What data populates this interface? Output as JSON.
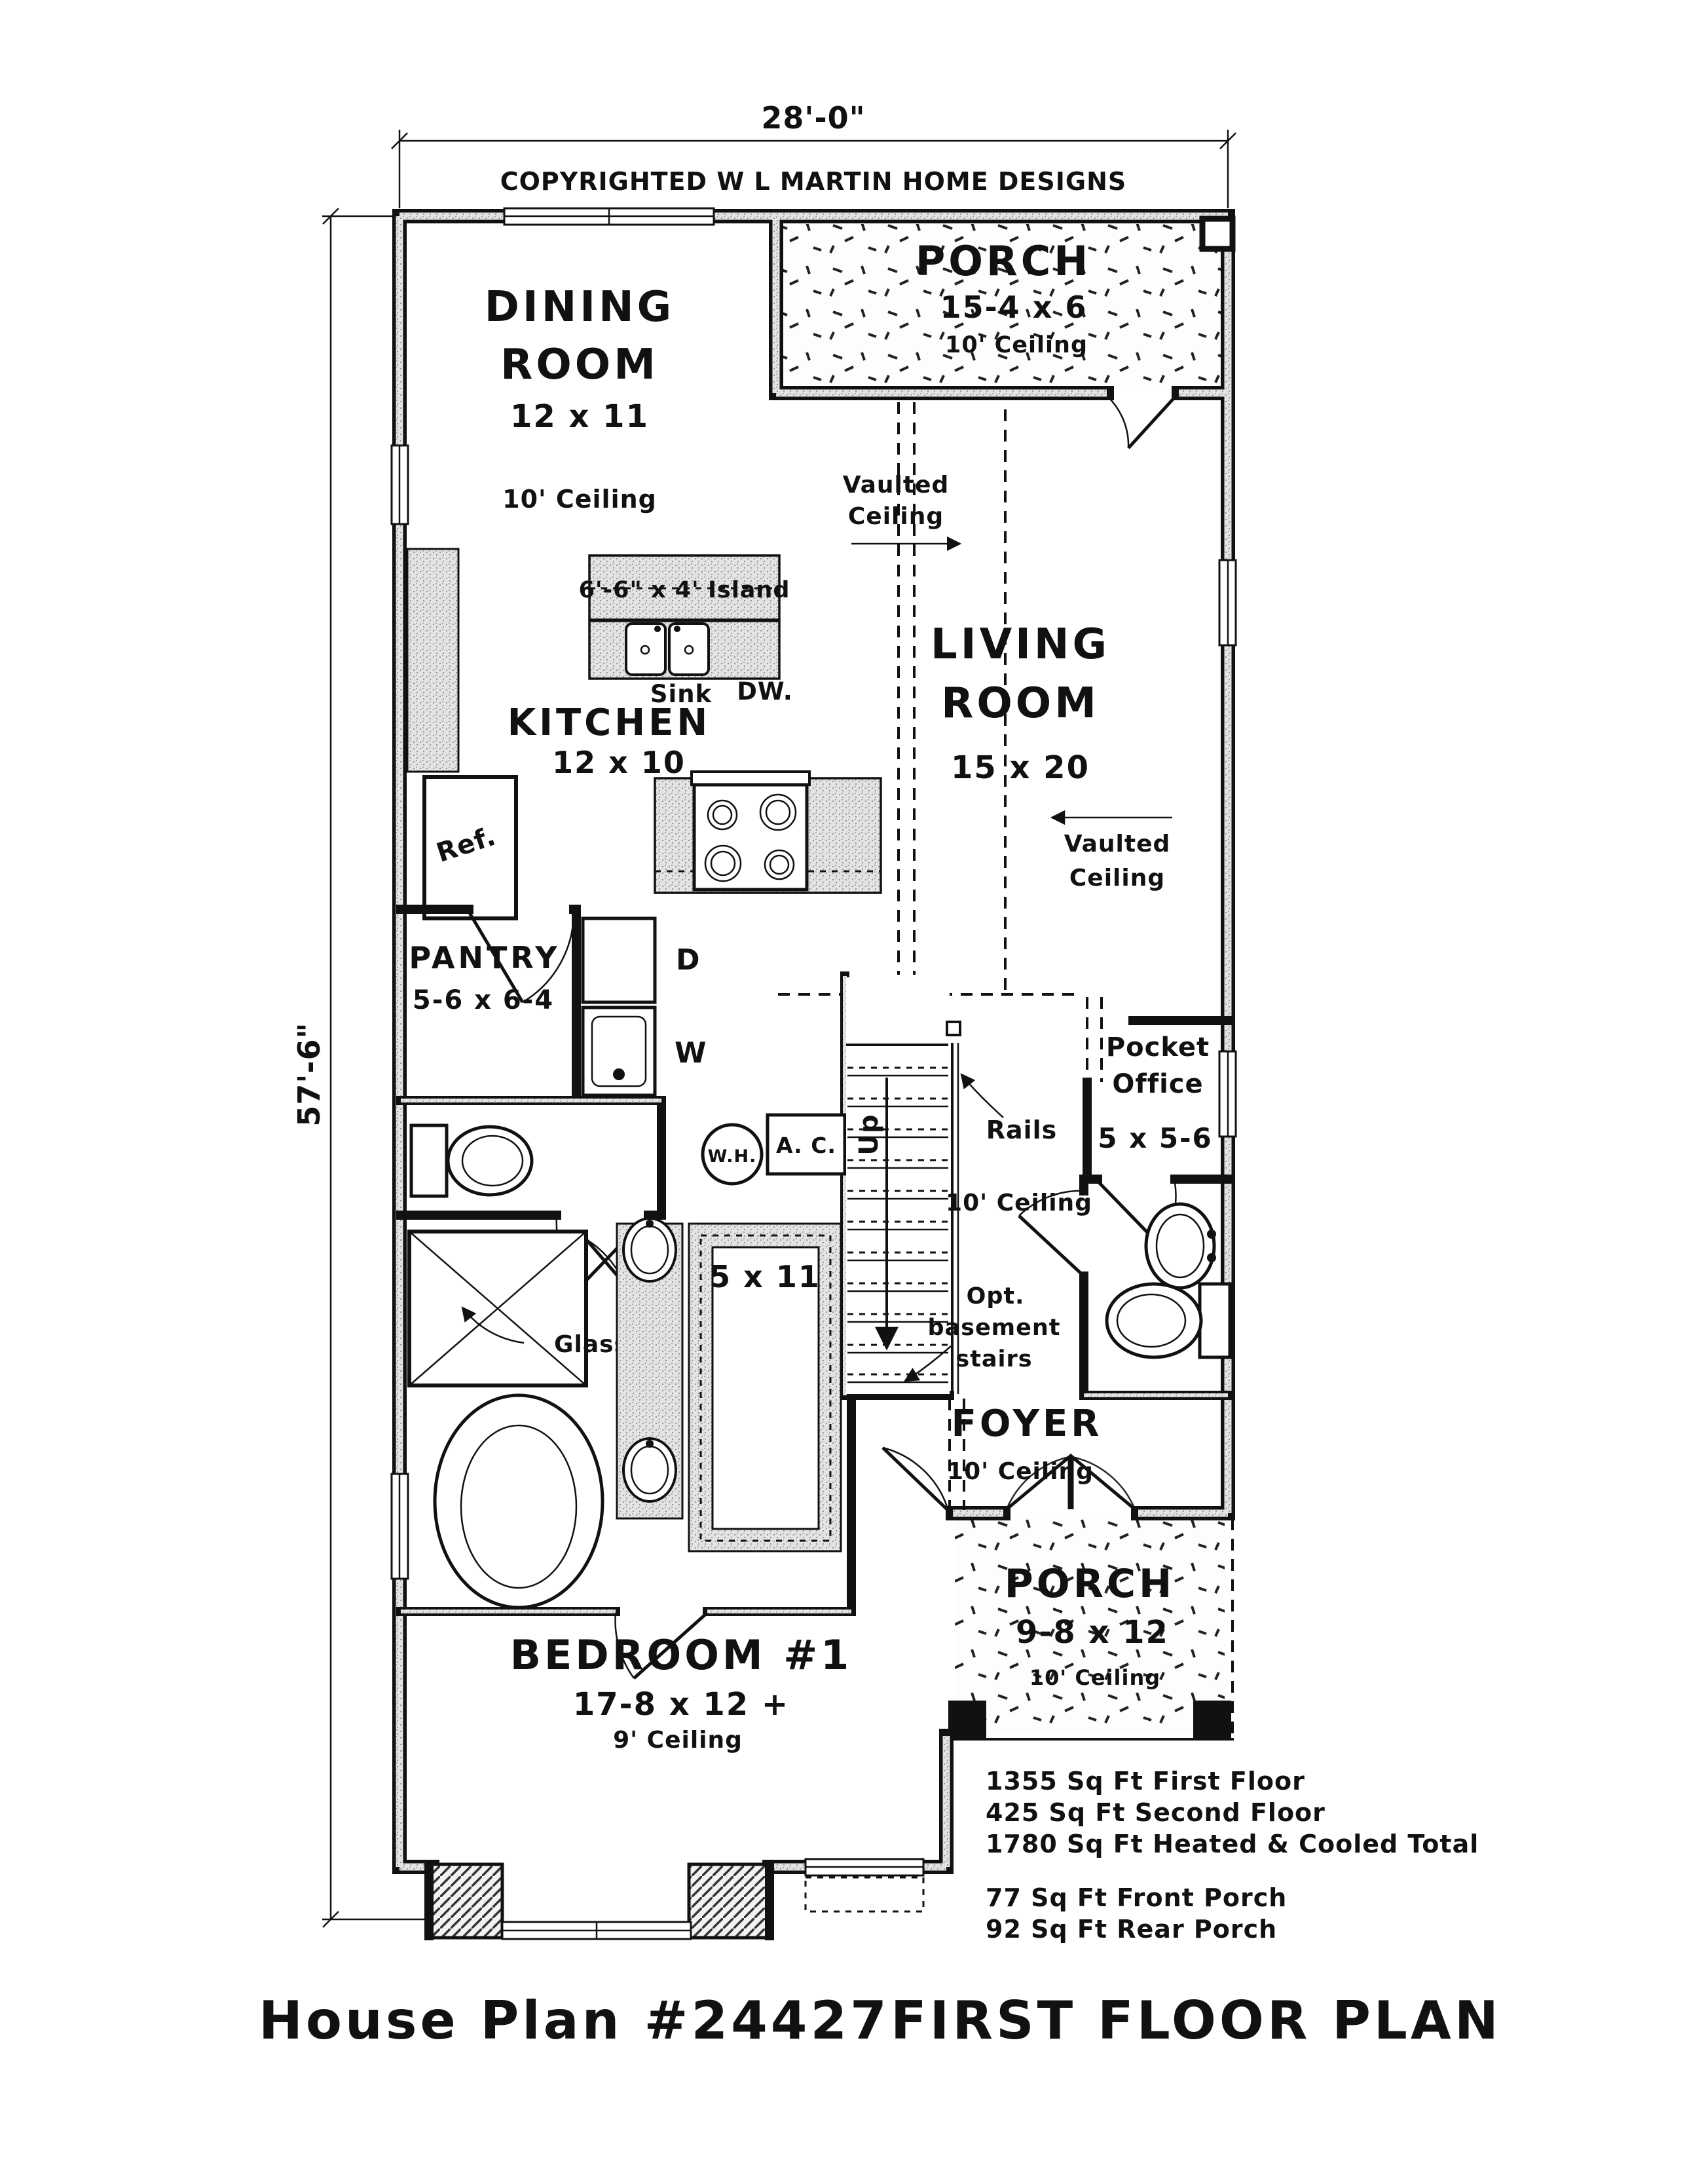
{
  "plan": {
    "width_dim": "28'-0\"",
    "depth_dim": "57'-6\"",
    "copyright": "COPYRIGHTED W L MARTIN HOME DESIGNS"
  },
  "rooms": {
    "dining": {
      "l1": "DINING",
      "l2": "ROOM",
      "size": "12 x 11",
      "ceiling": "10' Ceiling"
    },
    "rear_porch": {
      "name": "PORCH",
      "size": "15-4 x 6",
      "ceiling": "10' Ceiling"
    },
    "living": {
      "l1": "LIVING",
      "l2": "ROOM",
      "size": "15 x 20"
    },
    "kitchen": {
      "name": "KITCHEN",
      "size": "12 x 10"
    },
    "pantry": {
      "name": "PANTRY",
      "size": "5-6 x 6-4"
    },
    "pocket_office": {
      "l1": "Pocket",
      "l2": "Office",
      "size": "5 x 5-6"
    },
    "closet": {
      "size": "5 x 11"
    },
    "foyer": {
      "name": "FOYER",
      "ceiling": "10' Ceiling"
    },
    "front_porch": {
      "name": "PORCH",
      "size": "9-8 x 12",
      "ceiling": "10' Ceiling"
    },
    "bedroom1": {
      "name": "BEDROOM #1",
      "size": "17-8 x 12 +",
      "ceiling": "9' Ceiling"
    }
  },
  "labels": {
    "island": "6'-6\" x 4' Island",
    "sink": "Sink",
    "dw": "DW.",
    "ref": "Ref.",
    "dryer": "D",
    "washer": "W",
    "water_heater": "W.H.",
    "ac": "A. C.",
    "up": "Up",
    "rails": "Rails",
    "hall_ceiling": "10' Ceiling",
    "glass": "Glass",
    "vaulted1_l1": "Vaulted",
    "vaulted1_l2": "Ceiling",
    "vaulted2_l1": "Vaulted",
    "vaulted2_l2": "Ceiling",
    "opt_l1": "Opt.",
    "opt_l2": "basement",
    "opt_l3": "stairs"
  },
  "area_summary": {
    "first_floor": "1355 Sq Ft First Floor",
    "second_floor": "425 Sq Ft Second Floor",
    "total": "1780 Sq Ft Heated & Cooled Total",
    "front_porch": "77 Sq Ft Front Porch",
    "rear_porch": "92 Sq Ft Rear Porch"
  },
  "title_block": {
    "plan_number": "House Plan #24427",
    "sheet_name": "FIRST FLOOR PLAN"
  }
}
